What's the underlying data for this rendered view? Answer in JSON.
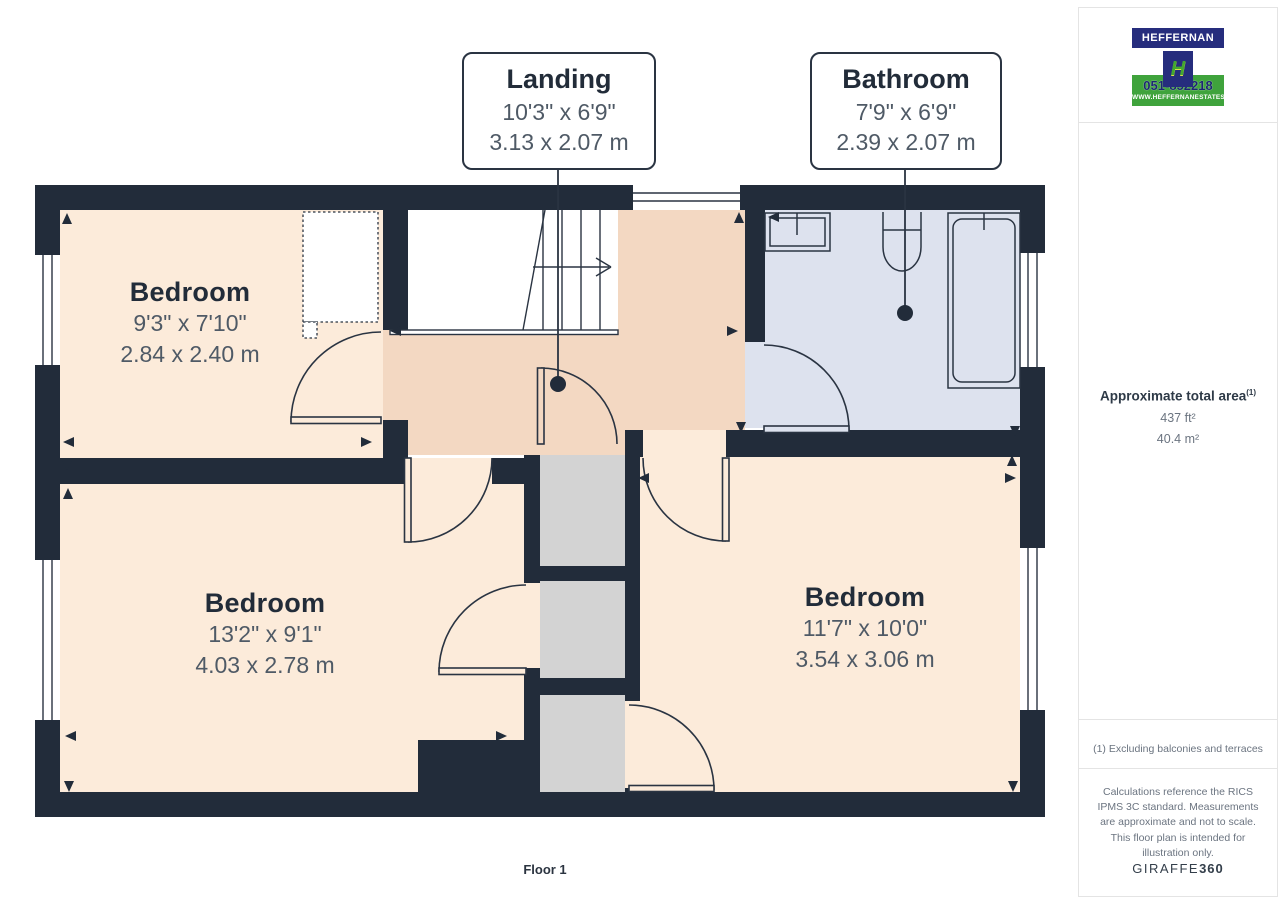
{
  "floor_plan": {
    "floor_label": "Floor 1",
    "rooms": [
      {
        "name": "Bedroom",
        "imperial": "9'3\" x 7'10\"",
        "metric": "2.84 x 2.40 m"
      },
      {
        "name": "Bedroom",
        "imperial": "13'2\" x 9'1\"",
        "metric": "4.03 x 2.78 m"
      },
      {
        "name": "Bedroom",
        "imperial": "11'7\" x 10'0\"",
        "metric": "3.54 x 3.06 m"
      }
    ],
    "callouts": [
      {
        "name": "Landing",
        "imperial": "10'3\" x 6'9\"",
        "metric": "3.13 x 2.07 m"
      },
      {
        "name": "Bathroom",
        "imperial": "7'9\" x 6'9\"",
        "metric": "2.39 x 2.07 m"
      }
    ]
  },
  "sidebar": {
    "area_title": "Approximate total area",
    "area_superscript": "(1)",
    "area_ft": "437 ft²",
    "area_m": "40.4 m²",
    "footnote": "(1) Excluding balconies and terraces",
    "disclaimer": "Calculations reference the RICS IPMS 3C standard. Measurements are approximate and not to scale. This floor plan is intended for illustration only.",
    "brand": "GIRAFFE",
    "brand_bold": "360"
  },
  "logo": {
    "name": "HEFFERNAN",
    "monogram": "H",
    "phone": "051-852218",
    "website": "WWW.HEFFERNANESTATES.IE"
  },
  "colors": {
    "wall": "#222c3a",
    "room": "#fcebda",
    "landing": "#f3d8c2",
    "bathroom": "#dde2ee",
    "closet": "#d3d3d3",
    "brand_navy": "#262d7d",
    "brand_green": "#3fa33c"
  }
}
